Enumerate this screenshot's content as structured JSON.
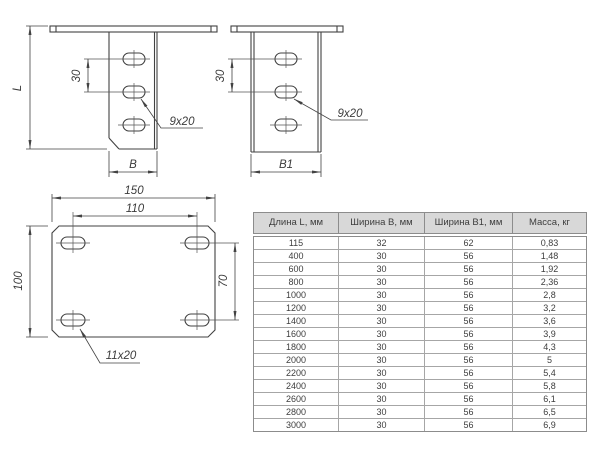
{
  "drawings": {
    "front_view": {
      "length_label": "L",
      "pitch_label": "30",
      "width_label": "B",
      "slot_label": "9x20"
    },
    "side_view": {
      "pitch_label": "30",
      "width_label": "B1",
      "slot_label": "9x20"
    },
    "plate_view": {
      "width_label": "150",
      "hole_spacing_x_label": "110",
      "height_label": "100",
      "hole_spacing_y_label": "70",
      "slot_label": "11x20"
    }
  },
  "table": {
    "columns": [
      "Длина L, мм",
      "Ширина B, мм",
      "Ширина B1, мм",
      "Масса, кг"
    ],
    "rows": [
      [
        "115",
        "32",
        "62",
        "0,83"
      ],
      [
        "400",
        "30",
        "56",
        "1,48"
      ],
      [
        "600",
        "30",
        "56",
        "1,92"
      ],
      [
        "800",
        "30",
        "56",
        "2,36"
      ],
      [
        "1000",
        "30",
        "56",
        "2,8"
      ],
      [
        "1200",
        "30",
        "56",
        "3,2"
      ],
      [
        "1400",
        "30",
        "56",
        "3,6"
      ],
      [
        "1600",
        "30",
        "56",
        "3,9"
      ],
      [
        "1800",
        "30",
        "56",
        "4,3"
      ],
      [
        "2000",
        "30",
        "56",
        "5"
      ],
      [
        "2200",
        "30",
        "56",
        "5,4"
      ],
      [
        "2400",
        "30",
        "56",
        "5,8"
      ],
      [
        "2600",
        "30",
        "56",
        "6,1"
      ],
      [
        "2800",
        "30",
        "56",
        "6,5"
      ],
      [
        "3000",
        "30",
        "56",
        "6,9"
      ]
    ]
  },
  "colors": {
    "line": "#424242",
    "thin_line": "#555555",
    "table_border": "#8c8c8c",
    "table_inner_border": "#a6a6a6",
    "header_bg": "#d8d8d8",
    "text": "#3d3d3d"
  }
}
